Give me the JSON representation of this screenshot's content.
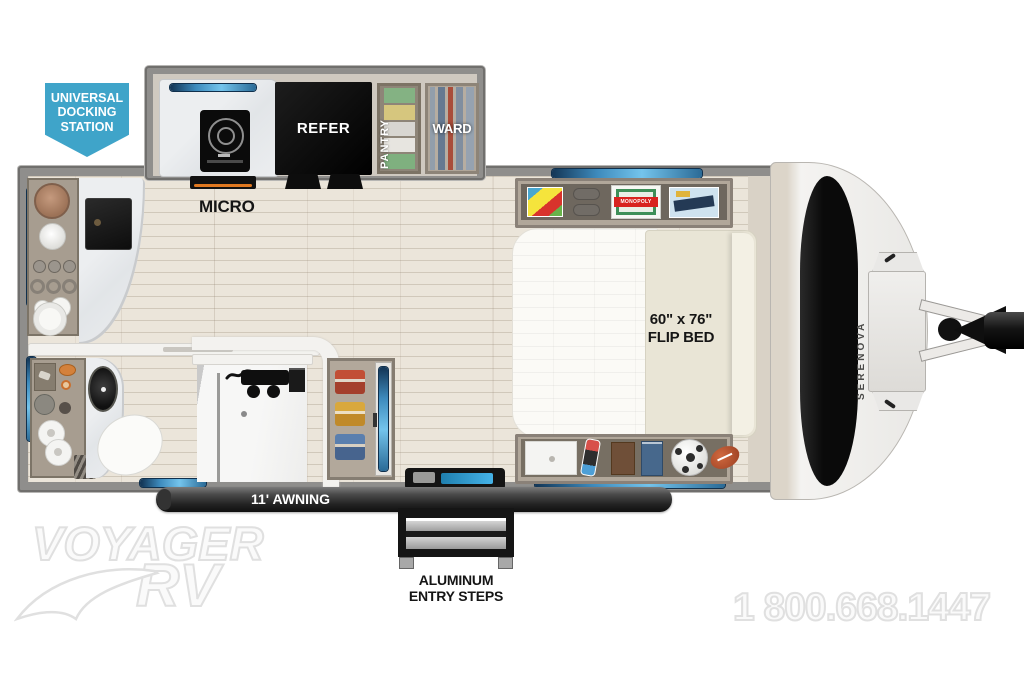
{
  "badge": {
    "line1": "UNIVERSAL",
    "line2": "DOCKING",
    "line3": "STATION",
    "color": "#3fa4c9"
  },
  "labels": {
    "micro": "MICRO",
    "refer": "REFER",
    "pantry": "PANTRY",
    "ward": "WARD",
    "monopoly": "MONOPOLY",
    "bed_size": "60\" x 76\"",
    "bed_name": "FLIP BED",
    "awning": "11' AWNING",
    "steps_line1": "ALUMINUM",
    "steps_line2": "ENTRY STEPS",
    "model": "SERENOVA"
  },
  "watermark": {
    "brand_line1": "VOYAGER",
    "brand_line2": "RV",
    "phone": "1 800.668.1447"
  },
  "colors": {
    "badge_blue": "#3fa4c9",
    "window_blue": "#3d8abc",
    "wall_gray": "#8f8e8c",
    "floor_wood": "#ebe5da",
    "awning_dark": "#2b2b2b",
    "accent_orange": "#e07820"
  }
}
